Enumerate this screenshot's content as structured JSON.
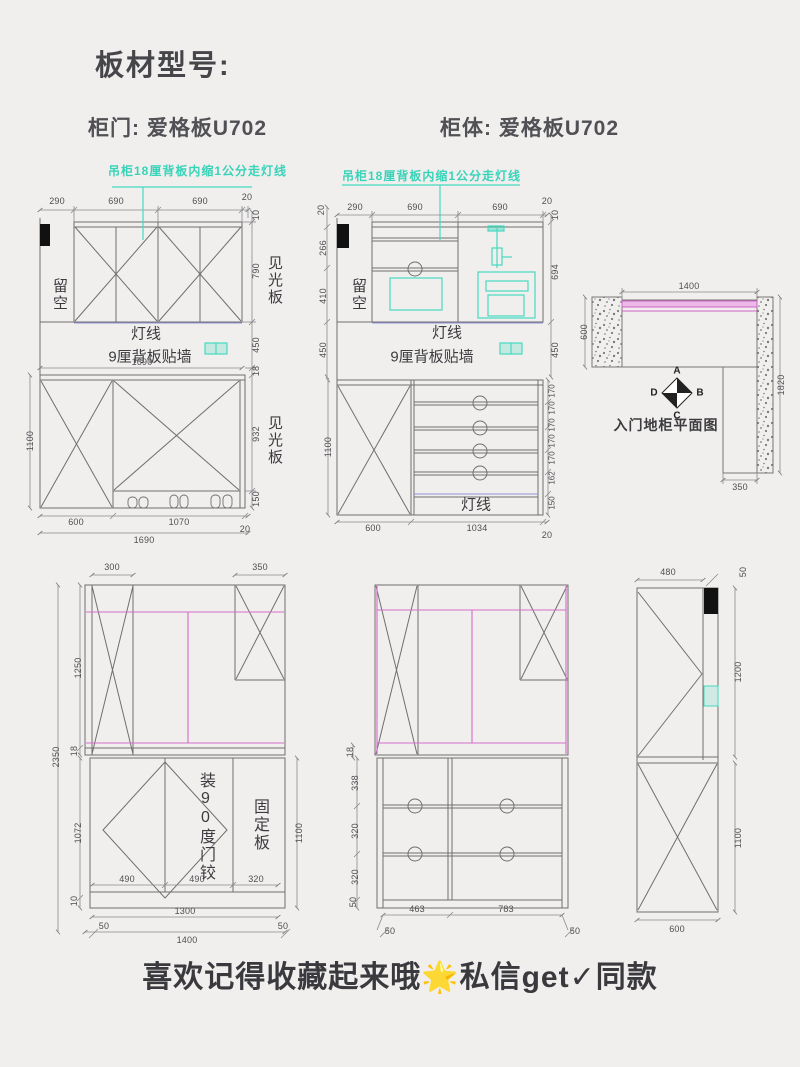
{
  "header": {
    "title": "板材型号:",
    "door": "柜门: 爱格板U702",
    "body": "柜体: 爱格板U702"
  },
  "annotation": "吊柜18厘背板内缩1公分走灯线",
  "footer": {
    "caption": "喜欢记得收藏起来哦🌟私信get✓同款"
  },
  "colors": {
    "teal": "#45d9c0",
    "pink": "#d46ccc",
    "line": "#6f6f6f",
    "lamp": "#9090d8"
  },
  "d1": {
    "top": [
      "290",
      "690",
      "690",
      "20"
    ],
    "right_upper": [
      "10",
      "790",
      "450",
      "18"
    ],
    "labels": {
      "liukong": "留空",
      "jianguangban": "见光板",
      "dengxian": "灯线",
      "beiban": "9厘背板贴墙"
    },
    "mid_width": "1690",
    "left_lower": "1100",
    "right_lower": [
      "932",
      "150"
    ],
    "bottom": [
      "600",
      "1070",
      "20",
      "1690"
    ]
  },
  "d2": {
    "top": [
      "290",
      "690",
      "690",
      "20"
    ],
    "left_upper": [
      "20",
      "266",
      "410",
      "450"
    ],
    "right_upper": [
      "10",
      "694",
      "450"
    ],
    "labels": {
      "liukong": "留空",
      "dengxian": "灯线",
      "beiban": "9厘背板贴墙",
      "dengxian2": "灯线"
    },
    "left_lower": "1100",
    "right_lower": [
      "170",
      "170",
      "170",
      "170",
      "170",
      "162",
      "150"
    ],
    "bottom": [
      "600",
      "1034",
      "20"
    ]
  },
  "d3": {
    "top": "1400",
    "left": "600",
    "right": "1820",
    "bottom": "350",
    "compass": {
      "a": "A",
      "b": "B",
      "c": "C",
      "d": "D"
    },
    "caption": "入门地柜平面图"
  },
  "d4": {
    "top": [
      "300",
      "350"
    ],
    "left": [
      "2350",
      "1250",
      "18",
      "1072",
      "10"
    ],
    "right": "1100",
    "inner": [
      "490",
      "490",
      "320"
    ],
    "bottom": [
      "1300",
      "50",
      "1400",
      "50"
    ],
    "hinge": "装90度门铰",
    "fixed": "固定板"
  },
  "d5": {
    "left": [
      "18",
      "338",
      "320",
      "320",
      "50"
    ],
    "bottom": [
      "463",
      "783"
    ],
    "offsets": [
      "50",
      "50"
    ]
  },
  "d6": {
    "top": "480",
    "top_offset": "50",
    "right": [
      "1200",
      "1100"
    ],
    "bottom": "600"
  }
}
